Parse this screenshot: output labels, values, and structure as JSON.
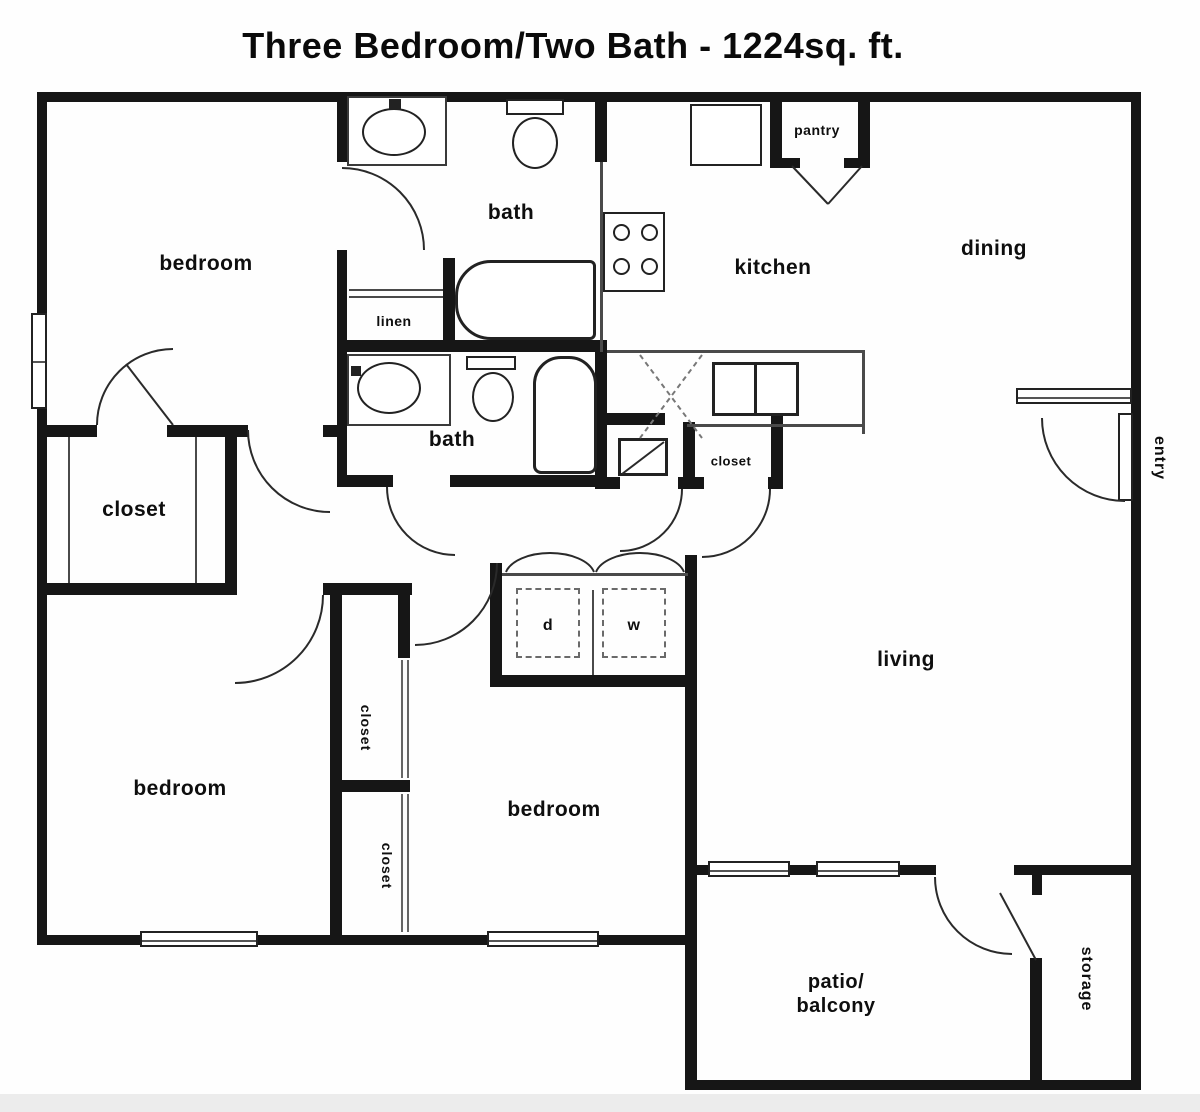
{
  "title": "Three Bedroom/Two Bath - 1224sq. ft.",
  "rooms": {
    "bedroom_master": "bedroom",
    "bedroom_left": "bedroom",
    "bedroom_middle": "bedroom",
    "bath_upper": "bath",
    "bath_lower": "bath",
    "linen": "linen",
    "kitchen": "kitchen",
    "pantry": "pantry",
    "dining": "dining",
    "living": "living",
    "entry": "entry",
    "walkin_closet": "closet",
    "hall_closet": "closet",
    "bedroom_left_closet": "closet",
    "bedroom_middle_closet": "closet",
    "storage": "storage",
    "patio_line1": "patio/",
    "patio_line2": "balcony",
    "dryer_abbrev": "d",
    "washer_abbrev": "w"
  },
  "colors": {
    "wall": "#161616",
    "background": "#ffffff",
    "thin_line": "#4a4a4a"
  }
}
